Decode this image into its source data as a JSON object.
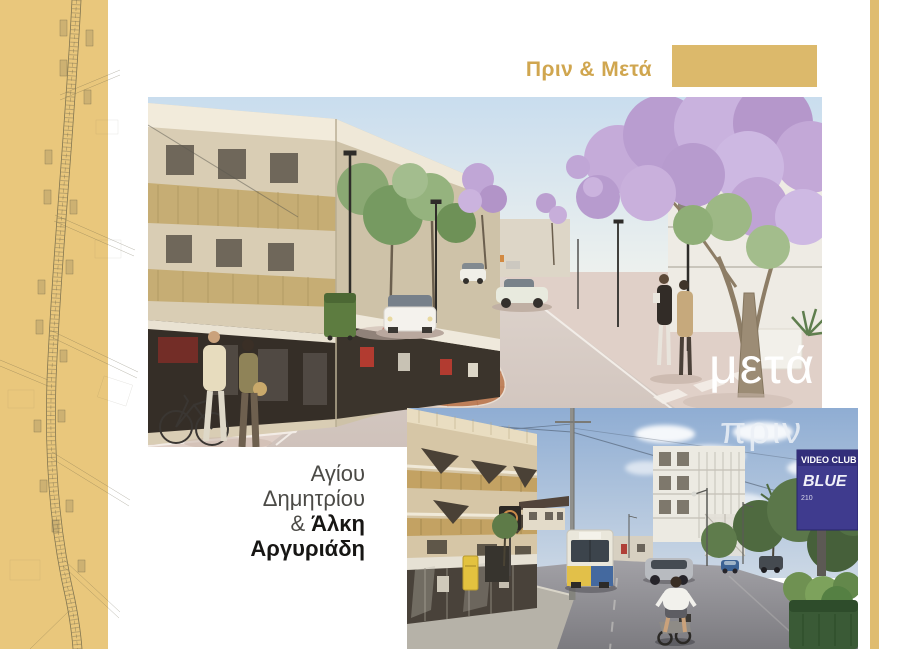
{
  "header": {
    "title": "Πριν & Μετά"
  },
  "after": {
    "label": "μετά"
  },
  "before": {
    "label": "πριν",
    "sign": {
      "line1": "VIDEO CLUB",
      "line2": "BLUE",
      "line3": "210"
    }
  },
  "location": {
    "line1": "Αγίου",
    "line2": "Δημητρίου",
    "line3_prefix": "&",
    "line3_bold": "Άλκη",
    "line4": "Αργυριάδη"
  },
  "colors": {
    "sidebar_gold": "#e9c77c",
    "block_gold": "#dcb96b",
    "strip_gold": "#dfbc70",
    "title_gold": "#d0a64f"
  }
}
